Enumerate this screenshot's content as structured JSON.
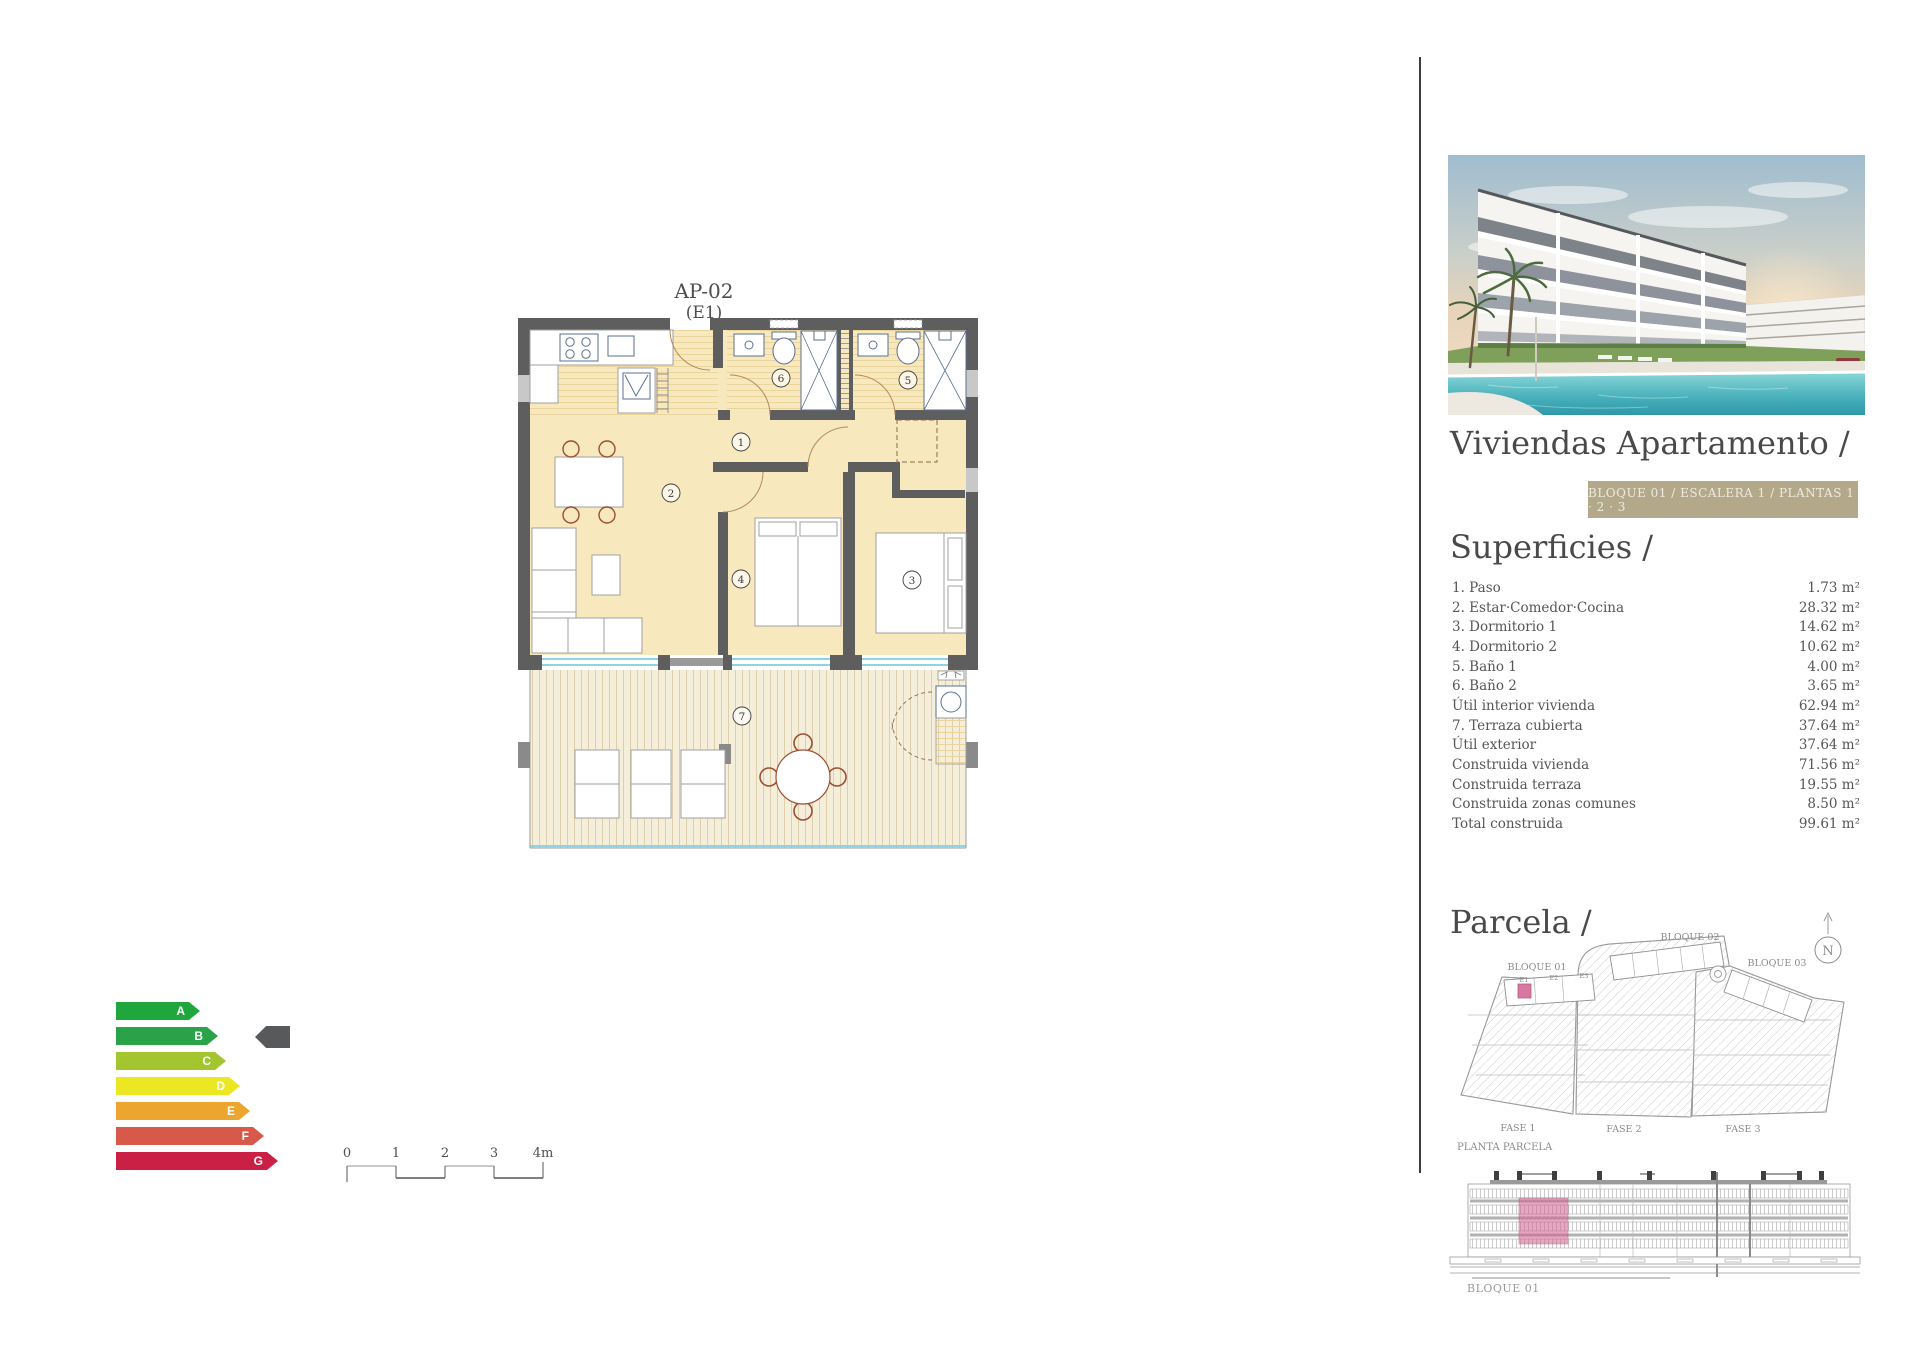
{
  "plan": {
    "title": "AP-02",
    "subtitle": "(E1)",
    "rooms": [
      "1",
      "2",
      "3",
      "4",
      "5",
      "6",
      "7"
    ]
  },
  "energy": {
    "marker_level": "B",
    "marker_color": "#58595b",
    "levels": [
      {
        "label": "A",
        "color": "#1fa63d",
        "width": 84
      },
      {
        "label": "B",
        "color": "#2aa348",
        "width": 102
      },
      {
        "label": "C",
        "color": "#a3c52f",
        "width": 110
      },
      {
        "label": "D",
        "color": "#ece723",
        "width": 124
      },
      {
        "label": "E",
        "color": "#eca52e",
        "width": 134
      },
      {
        "label": "F",
        "color": "#d8584a",
        "width": 148
      },
      {
        "label": "G",
        "color": "#cb2045",
        "width": 162
      }
    ]
  },
  "scale_bar": {
    "labels": [
      "0",
      "1",
      "2",
      "3",
      "4m"
    ]
  },
  "panel": {
    "title": "Viviendas Apartamento /",
    "badge": "BLOQUE 01  / ESCALERA 1 / PLANTAS 1 · 2 · 3",
    "superficies": {
      "heading": "Superficies /",
      "rows": [
        {
          "label": "1. Paso",
          "value": "1.73 m²"
        },
        {
          "label": "2. Estar·Comedor·Cocina",
          "value": "28.32 m²"
        },
        {
          "label": "3. Dormitorio 1",
          "value": "14.62 m²"
        },
        {
          "label": "4. Dormitorio 2",
          "value": "10.62 m²"
        },
        {
          "label": "5. Baño 1",
          "value": "4.00 m²"
        },
        {
          "label": "6. Baño 2",
          "value": "3.65 m²"
        },
        {
          "label": "Útil interior vivienda",
          "value": "62.94 m²"
        },
        {
          "label": "7. Terraza cubierta",
          "value": "37.64 m²"
        },
        {
          "label": "Útil exterior",
          "value": "37.64 m²"
        },
        {
          "label": "Construida vivienda",
          "value": "71.56 m²"
        },
        {
          "label": "Construida terraza",
          "value": "19.55 m²"
        },
        {
          "label": "Construida zonas comunes",
          "value": "8.50 m²"
        },
        {
          "label": "Total construida",
          "value": "99.61 m²"
        }
      ]
    },
    "parcela": {
      "heading": "Parcela /",
      "bloque01": "BLOQUE 01",
      "bloque02": "BLOQUE 02",
      "bloque03": "BLOQUE 03",
      "fase1": "FASE 1",
      "fase2": "FASE 2",
      "fase3": "FASE 3",
      "units": [
        "E1",
        "E2",
        "E3"
      ],
      "caption": "PLANTA PARCELA",
      "north": "N"
    },
    "elevation": {
      "label": "BLOQUE 01"
    }
  },
  "colors": {
    "accent_pink": "#d2608f",
    "badge_bg": "#b3a98a",
    "wall": "#5e5e5e",
    "floor": "#f8e8bd",
    "terrace_floor": "#f5eedb",
    "glass": "#8fd4e4",
    "divider": "#3d3d3d"
  }
}
